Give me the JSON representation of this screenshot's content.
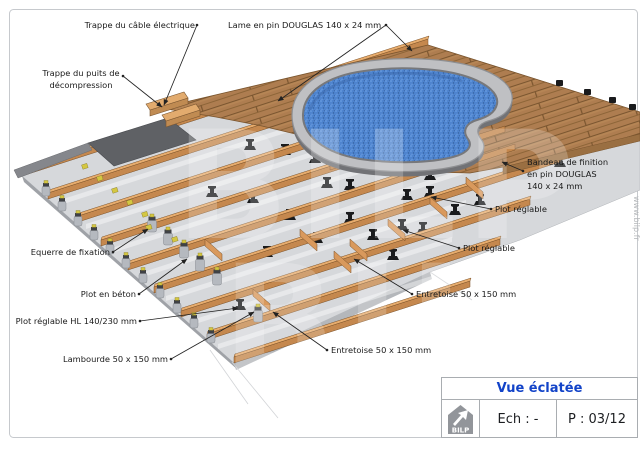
{
  "page": {
    "watermark_big": "BILP",
    "watermark_side": "www.bilp.fr"
  },
  "diagram": {
    "labels": {
      "trappe_cable": "Trappe du câble électrique",
      "lame": "Lame en pin DOUGLAS 140 x 24 mm",
      "trappe_puits_1": "Trappe du puits de",
      "trappe_puits_2": "décompression",
      "bandeau_1": "Bandeau de finition",
      "bandeau_2": "en pin DOUGLAS",
      "bandeau_3": "140 x 24 mm",
      "plot_reglable_1": "Plot réglable",
      "plot_reglable_2": "Plot réglable",
      "equerre": "Equerre de fixation",
      "plot_beton": "Plot en béton",
      "plot_hl": "Plot réglable HL 140/230 mm",
      "lambourde": "Lambourde 50 x 150 mm",
      "entretoise_right": "Entretoise 50 x 150 mm",
      "entretoise_bottom": "Entretoise 50 x 150 mm"
    }
  },
  "titleblock": {
    "title": "Vue éclatée",
    "logo_text": "BILP",
    "scale_label": "Ech : -",
    "page_label": "P : 03/12"
  },
  "colors": {
    "deck_wood": "#ae7d50",
    "joist_wood": "#e7ac6d",
    "water_blue": "#4e84cf",
    "coping_gray": "#bfc0c3",
    "slab_gray": "#d6d8db",
    "title_blue": "#1243c8"
  }
}
